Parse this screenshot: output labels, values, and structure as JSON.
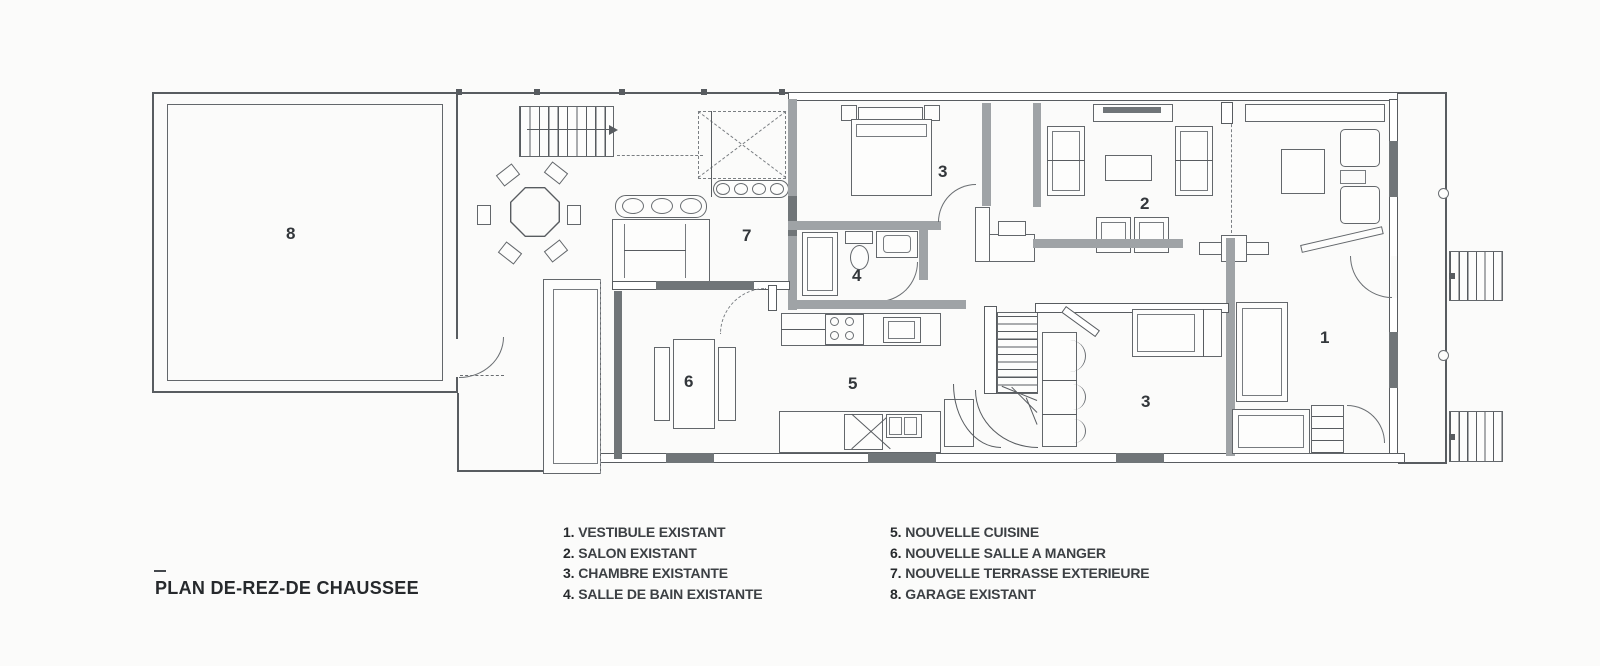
{
  "plan_title": "PLAN DE-REZ-DE CHAUSSEE",
  "legend": {
    "columns": [
      {
        "items": [
          {
            "num": "1.",
            "label": "VESTIBULE EXISTANT"
          },
          {
            "num": "2.",
            "label": "SALON EXISTANT"
          },
          {
            "num": "3.",
            "label": "CHAMBRE EXISTANTE"
          },
          {
            "num": "4.",
            "label": "SALLE DE BAIN EXISTANTE"
          }
        ]
      },
      {
        "items": [
          {
            "num": "5.",
            "label": "NOUVELLE CUISINE"
          },
          {
            "num": "6.",
            "label": "NOUVELLE SALLE A MANGER"
          },
          {
            "num": "7.",
            "label": "NOUVELLE TERRASSE EXTERIEURE"
          },
          {
            "num": "8.",
            "label": "GARAGE EXISTANT"
          }
        ]
      }
    ]
  },
  "plan": {
    "labels": {
      "vestibule": "1",
      "salon": "2",
      "bedroom_top": "3",
      "bedroom_bottom": "3",
      "bathroom": "4",
      "kitchen": "5",
      "dining": "6",
      "terrace": "7",
      "garage": "8"
    }
  },
  "colors": {
    "line": "#585c60",
    "wall_fill": "#9fa3a6",
    "window_fill": "#707578",
    "text": "#2b2f33",
    "background": "#fbfbfa"
  }
}
